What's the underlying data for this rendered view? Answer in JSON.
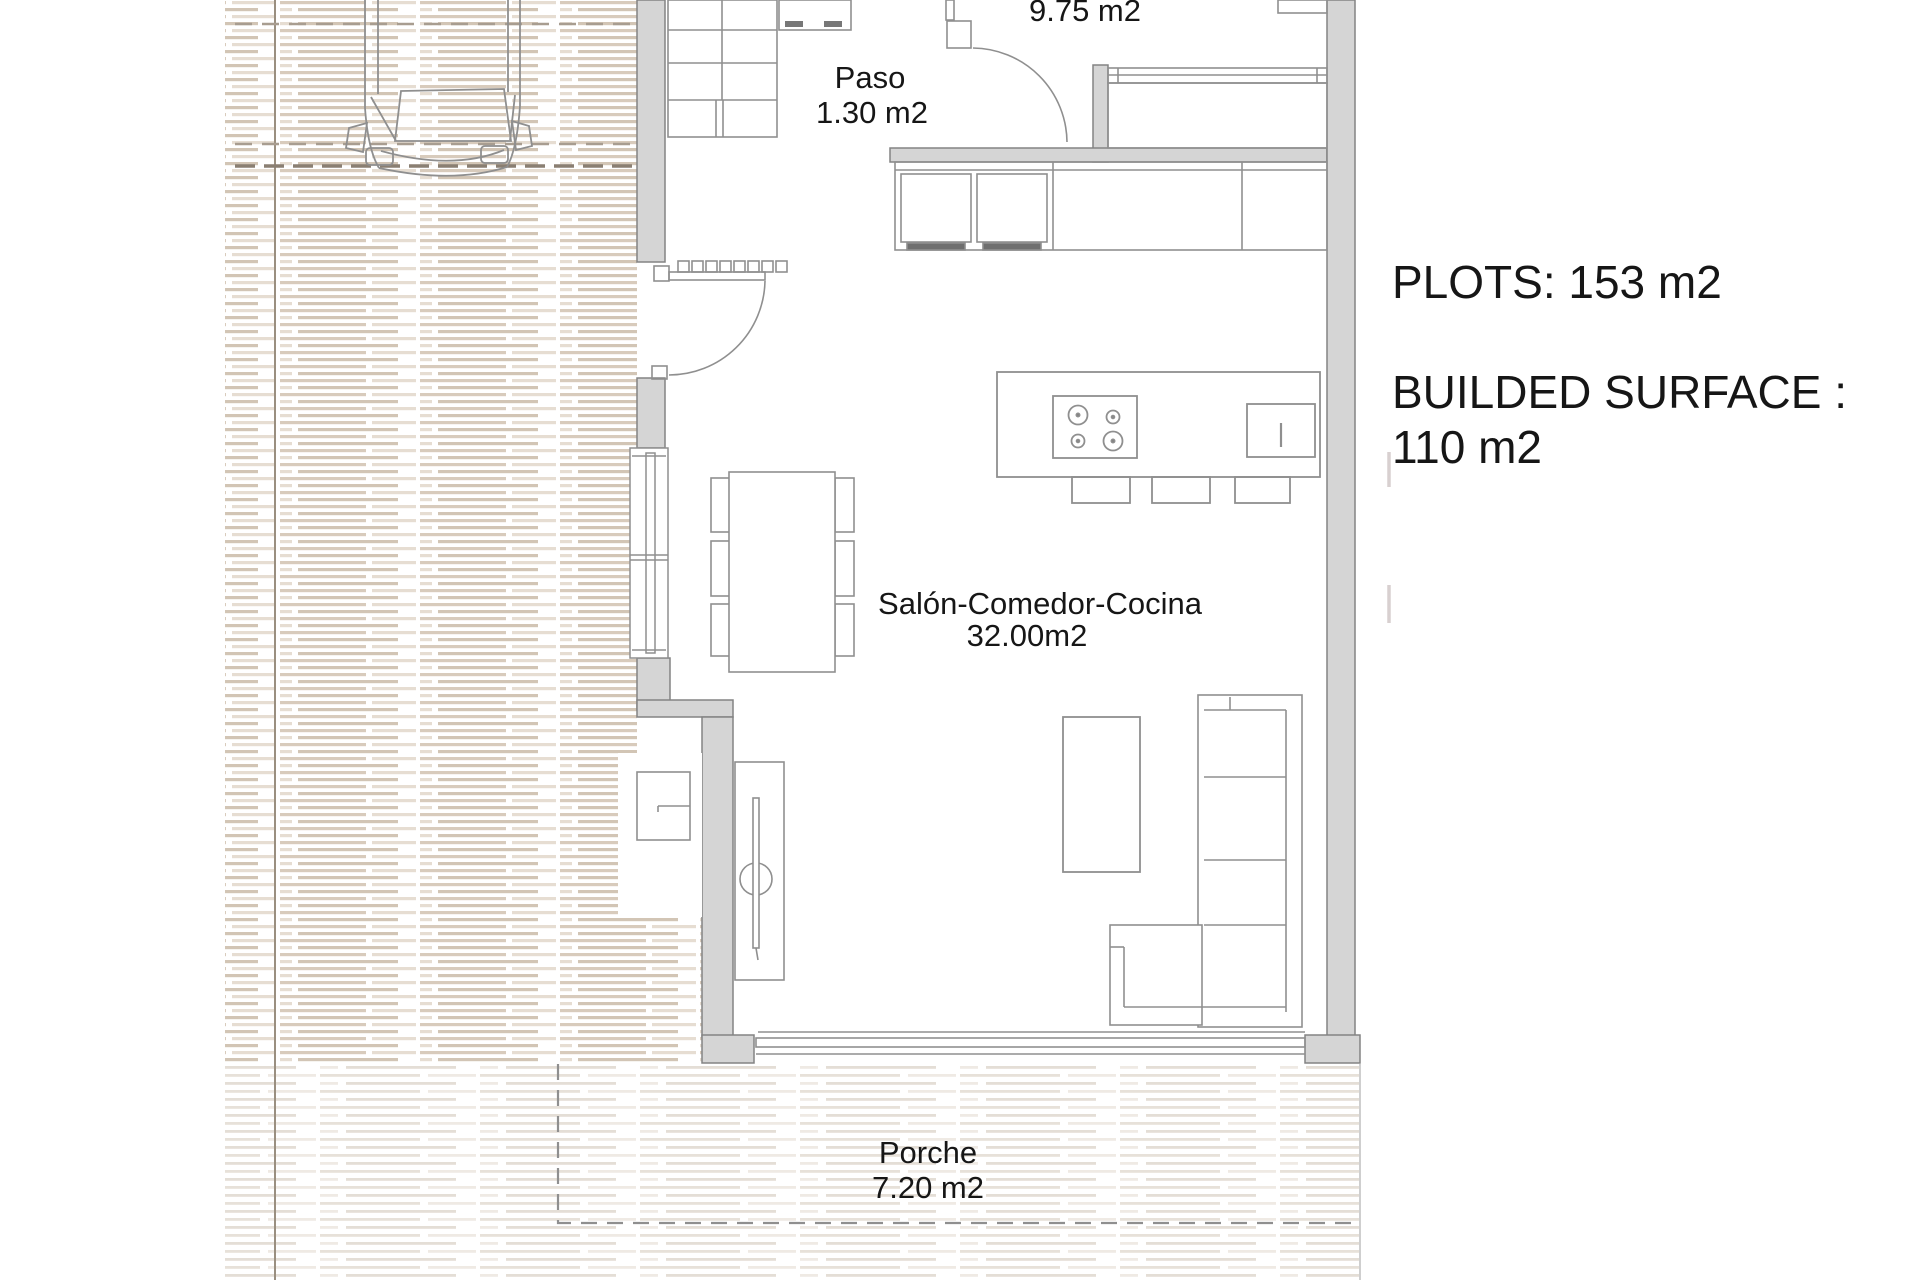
{
  "info_panel": {
    "plots": "PLOTS: 153 m2",
    "built_line1": "BUILDED SURFACE :",
    "built_line2": "110 m2"
  },
  "rooms": {
    "paso": {
      "name": "Paso",
      "area": "1.30 m2"
    },
    "bedroom": {
      "area": "9.75 m2"
    },
    "salon": {
      "name": "Salón-Comedor-Cocina",
      "area": "32.00m2"
    },
    "porche": {
      "name": "Porche",
      "area": "7.20 m2"
    }
  },
  "colors": {
    "wall_fill": "#d5d5d5",
    "wall_stroke": "#838383",
    "furniture_line": "#8f8f8f",
    "hatch_dark": "#d8cbbc",
    "hatch_light": "#e7e1d9",
    "text": "#161616"
  }
}
